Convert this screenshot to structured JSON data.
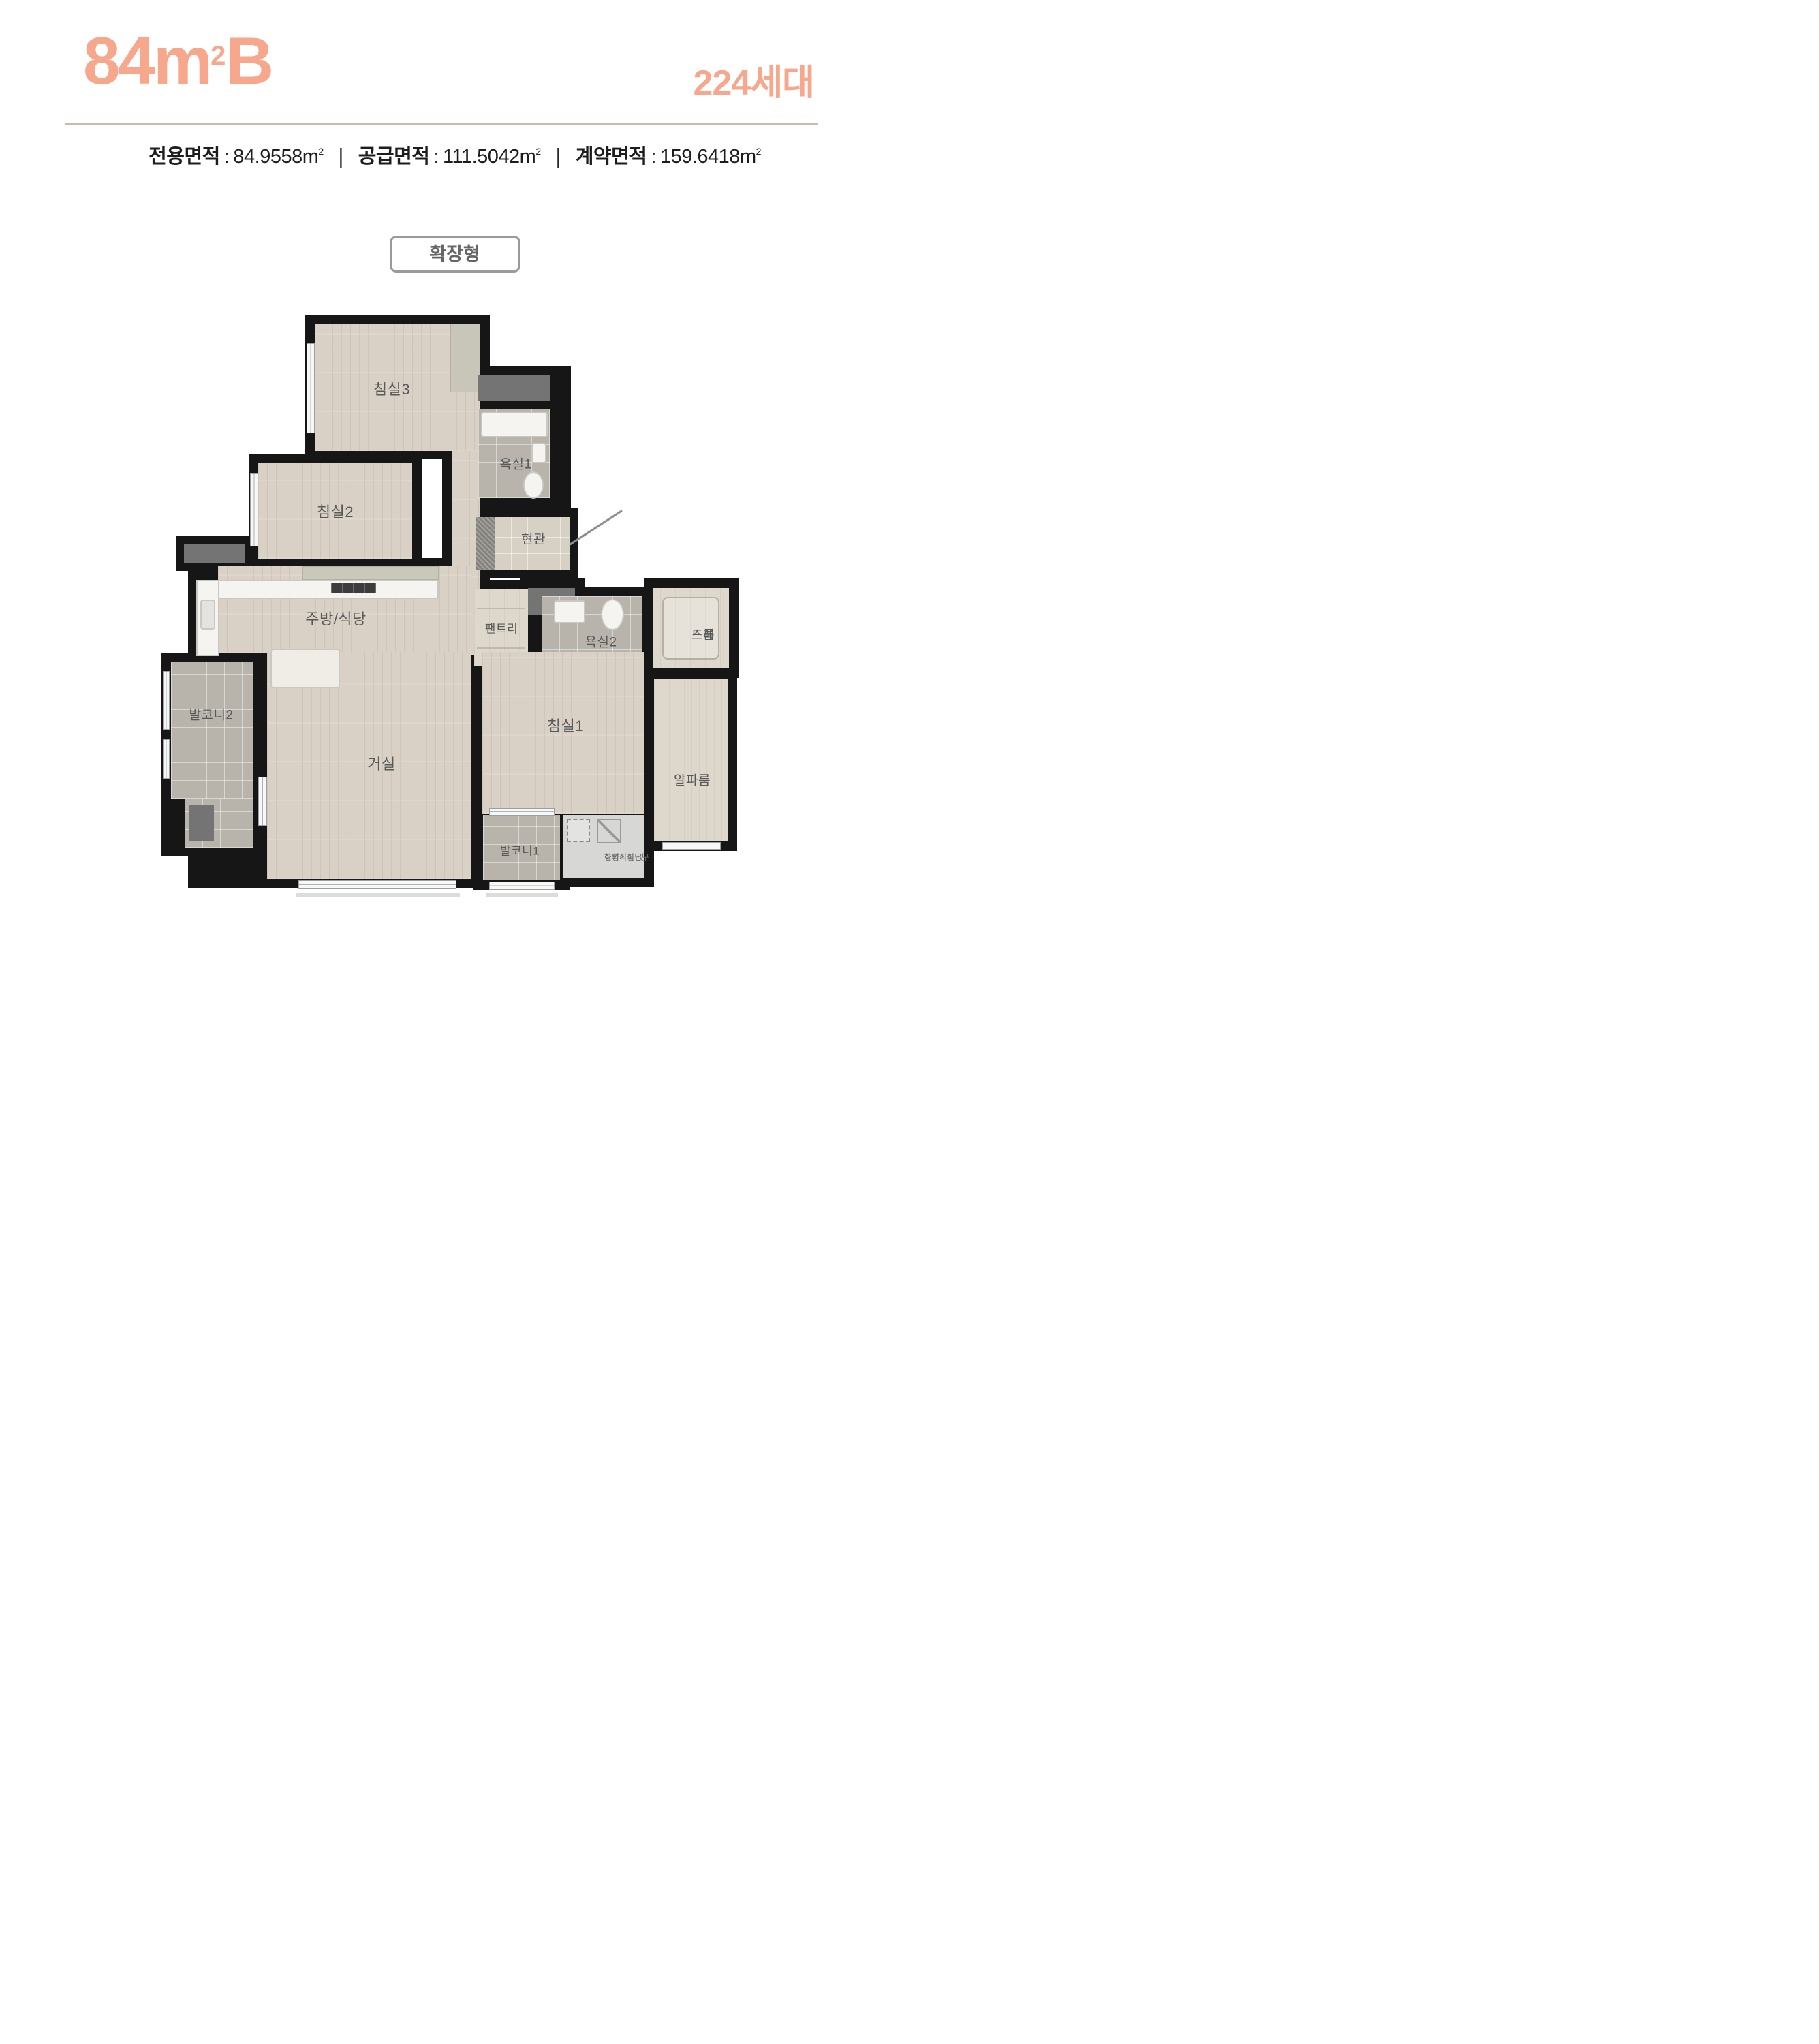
{
  "header": {
    "plan_name": {
      "area": "84",
      "unit": "m",
      "sup": "2",
      "type": "B"
    },
    "household": {
      "count": "224",
      "label": "세대"
    }
  },
  "area_info": {
    "colon": ":",
    "separator": "|",
    "items": [
      {
        "label": "전용면적",
        "value": "84.9558",
        "unit": "m",
        "sup": "2"
      },
      {
        "label": "공급면적",
        "value": "111.5042",
        "unit": "m",
        "sup": "2"
      },
      {
        "label": "계약면적",
        "value": "159.6418",
        "unit": "m",
        "sup": "2"
      }
    ]
  },
  "badge": {
    "label": "확장형"
  },
  "rooms": {
    "bedroom3": "침실3",
    "bath1": "욕실1",
    "entrance": "현관",
    "bedroom2": "침실2",
    "kitchen": "주방/식당",
    "pantry": "팬트리",
    "bath2": "욕실2",
    "dress_line1": "드레",
    "dress_line2": "스룸",
    "balcony2": "발코니2",
    "living": "거실",
    "bedroom1": "침실1",
    "alpha": "알파룸",
    "balcony1": "발코니1",
    "outdoor_line1": "실외기실 및",
    "outdoor_line2": "하향식피난구"
  },
  "colors": {
    "accent": "#F6A78C",
    "divider": "#C9BCAC",
    "wall": "#161616",
    "label": "#595959"
  }
}
